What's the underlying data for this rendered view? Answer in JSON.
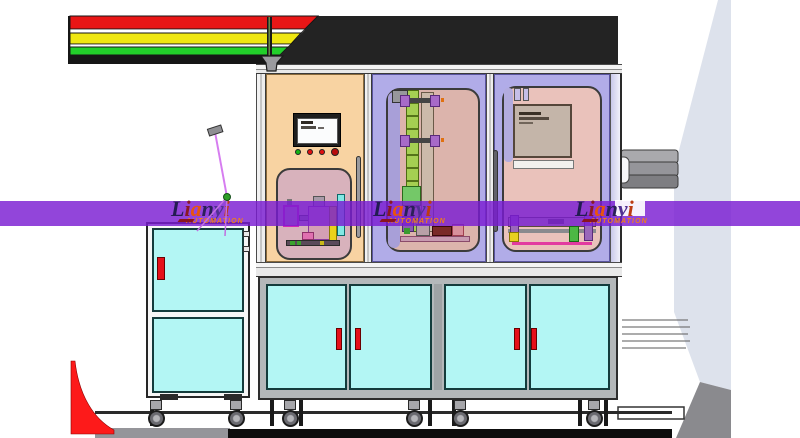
{
  "title": "Lianyi automated assembly machine render",
  "watermark": {
    "brand": "Lianyi",
    "subtitle": "AUTOMATION",
    "band_color": "#7a1cd2",
    "instances": 3,
    "letters": [
      {
        "ch": "L",
        "color": "#231c52"
      },
      {
        "ch": "i",
        "color": "#8a1825"
      },
      {
        "ch": "a",
        "color": "#e8540e"
      },
      {
        "ch": "n",
        "color": "#2a2058"
      },
      {
        "ch": "y",
        "color": "#503092"
      },
      {
        "ch": "i",
        "color": "#bc3a12"
      }
    ]
  },
  "signal_tower": {
    "colors_top_to_bottom": [
      "#e81616",
      "#efe712",
      "#22cf2a"
    ],
    "base_color": "#161616"
  },
  "hmi": {
    "screen": "#fbfcfd",
    "buttons": [
      "#14b414",
      "#e01010",
      "#e01010",
      "#b80c0c"
    ]
  },
  "theme": {
    "hood": "#232323",
    "door_left": "#f8d3a2",
    "door_mid": "#b1ace8",
    "window_pink_left": "#d8b2bc",
    "window_pink_mid": "#dcb4ac",
    "window_pink_right": "#eac2bb",
    "cabinet_cyan": "#b3f6f4",
    "frame_gray": "#b4b8ba",
    "handle_red": "#e51019",
    "belt_green": "#a5cf52",
    "blob_gray": "#dde2ec",
    "cylinder_gray": "#95959a",
    "floor_black": "#0d0d0d",
    "fin_red": "#fd1a1a",
    "tower_red": "#e81616",
    "tower_yellow": "#efe712",
    "tower_green": "#22cf2a",
    "sub_orange": "#ef7f18"
  }
}
